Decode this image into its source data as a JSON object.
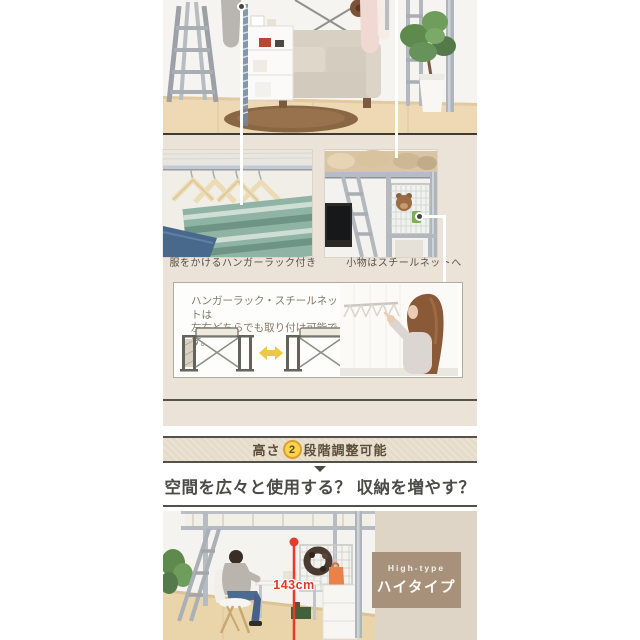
{
  "mid_section": {
    "caption_left": "服をかけるハンガーラック付き",
    "caption_right": "小物はスチールネットへ",
    "info_box": {
      "line1": "ハンガーラック・スチールネットは",
      "line2": "左右どちらでも取り付け可能です。"
    }
  },
  "banner": {
    "prefix": "高さ",
    "step_number": "2",
    "suffix": "段階調整可能"
  },
  "headline": "空間を広々と使用する？ 収納を増やす？",
  "bottom_section": {
    "height_measurement": "143cm",
    "type_label_en": "High-type",
    "type_label_ja": "ハイタイプ"
  },
  "colors": {
    "section_beige": "#ebe3d7",
    "banner_beige": "#e6dcca",
    "border_dark": "#54504a",
    "accent_yellow": "#f8d44c",
    "accent_yellow_ring": "#dd9f2e",
    "measure_red": "#e8352a",
    "type_box_brown": "#a8917b",
    "type_column_beige": "#ded5c7"
  }
}
